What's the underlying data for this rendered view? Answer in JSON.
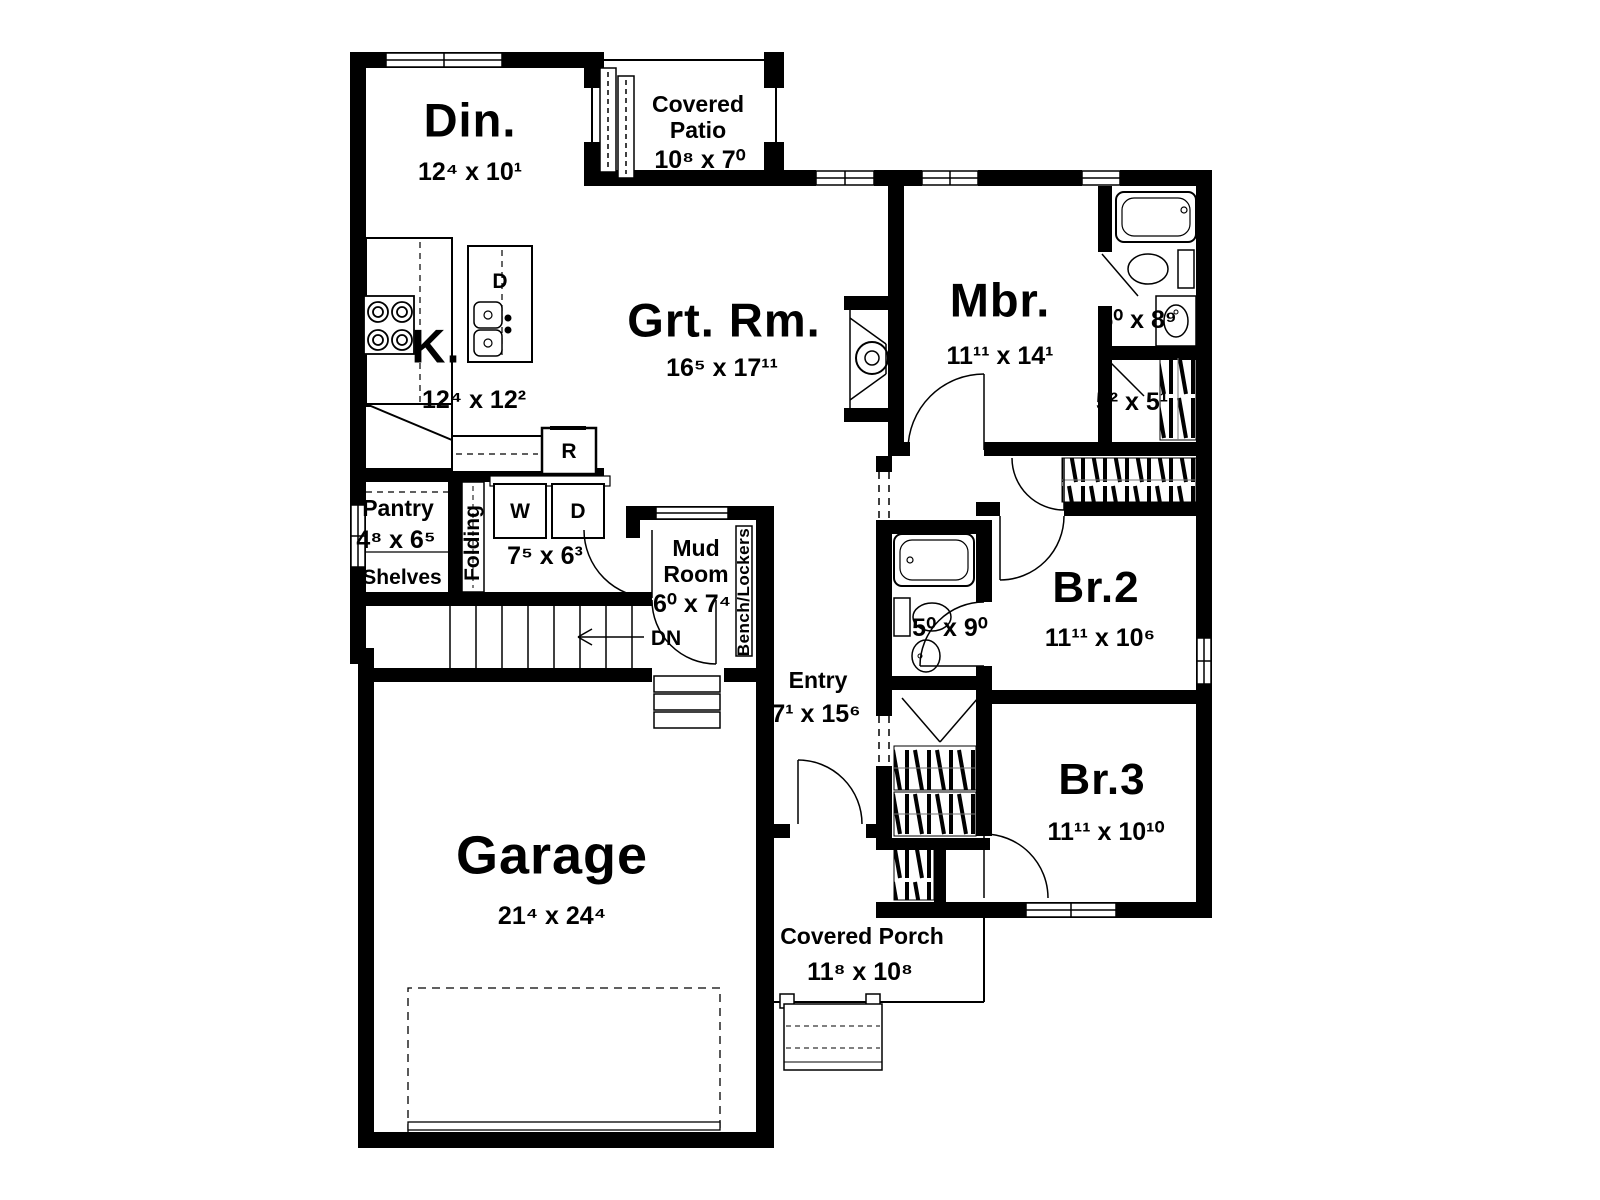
{
  "colors": {
    "ink": "#000000",
    "background": "#ffffff"
  },
  "plan": {
    "rooms": {
      "dining": {
        "name": "Din.",
        "dims": "12⁴ x 10¹"
      },
      "covered_patio": {
        "name1": "Covered",
        "name2": "Patio",
        "dims": "10⁸ x 7⁰"
      },
      "great_room": {
        "name": "Grt. Rm.",
        "dims": "16⁵ x 17¹¹"
      },
      "kitchen": {
        "name": "K.",
        "dims": "12⁴ x 12²"
      },
      "master_bedroom": {
        "name": "Mbr.",
        "dims": "11¹¹ x 14¹"
      },
      "master_bath": {
        "dims": "5⁰ x 8⁹"
      },
      "master_closet": {
        "dims": "5² x 5¹"
      },
      "pantry": {
        "name": "Pantry",
        "dims": "4⁸ x 6⁵",
        "shelves": "Shelves"
      },
      "laundry": {
        "dims": "7⁵ x 6³",
        "washer": "W",
        "dryer": "D",
        "folding": "Folding"
      },
      "mud_room": {
        "name1": "Mud",
        "name2": "Room",
        "dims": "6⁰ x 7⁴",
        "bench": "Bench/Lockers"
      },
      "hall_bath": {
        "dims": "5⁰ x 9⁰"
      },
      "bedroom2": {
        "name": "Br.2",
        "dims": "11¹¹ x 10⁶"
      },
      "bedroom3": {
        "name": "Br.3",
        "dims": "11¹¹ x 10¹⁰"
      },
      "entry": {
        "name": "Entry",
        "dims": "7¹ x 15⁶"
      },
      "garage": {
        "name": "Garage",
        "dims": "21⁴ x 24⁴"
      },
      "covered_porch": {
        "name": "Covered Porch",
        "dims": "11⁸ x 10⁸"
      }
    },
    "annotations": {
      "stairs_direction": "DN",
      "range": "R",
      "island_dishwasher": "D"
    }
  }
}
